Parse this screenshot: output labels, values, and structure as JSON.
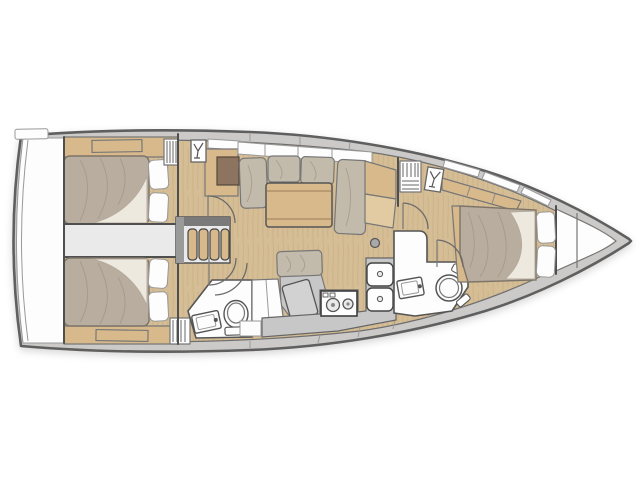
{
  "figure": {
    "type": "yacht-interior-floor-plan",
    "orientation": "bow-right",
    "rooms": [
      {
        "name": "stern-transom",
        "items": [
          "swim-platform",
          "boarding-step"
        ]
      },
      {
        "name": "aft-cabin-port",
        "items": [
          "double-berth",
          "pillow",
          "pillow",
          "storage-shelf",
          "louvered-locker",
          "cabin-door"
        ]
      },
      {
        "name": "aft-cabin-starboard",
        "items": [
          "double-berth",
          "pillow",
          "pillow",
          "storage-shelf",
          "louvered-locker",
          "cabin-door"
        ]
      },
      {
        "name": "companionway",
        "items": [
          "ladder-steps",
          "wardrobe-cabinet",
          "deck-hatch"
        ]
      },
      {
        "name": "aft-head",
        "items": [
          "toilet",
          "washbasin",
          "shower-bench",
          "door"
        ]
      },
      {
        "name": "salon",
        "items": [
          "u-shaped-settee",
          "folding-table",
          "sideboard",
          "nav-seat",
          "nav-desk",
          "mast-post"
        ]
      },
      {
        "name": "galley",
        "items": [
          "two-burner-stove",
          "double-sink",
          "worktop"
        ]
      },
      {
        "name": "forward-head",
        "items": [
          "toilet",
          "washbasin",
          "door"
        ]
      },
      {
        "name": "forward-cabin",
        "items": [
          "island-double-berth",
          "pillow",
          "pillow",
          "storage-shelf",
          "louvered-locker",
          "deck-hatch",
          "cabin-door"
        ]
      },
      {
        "name": "bow",
        "items": [
          "anchor-locker-bulkhead",
          "anchor-locker-bulkhead"
        ]
      }
    ]
  },
  "colors": {
    "page_bg": "#ffffff",
    "hull_outline": "#5f5f5f",
    "deck": "#cbcac8",
    "wall": "#4f4f4f",
    "floor": "#d5bd95",
    "floor_grain": "#c3a87c",
    "wood": "#d7b98b",
    "wood_light": "#e2cba2",
    "wood_dark": "#8d7460",
    "mattress": "#b8ad9f",
    "crease": "#a2968a",
    "cushion": "#c2bbac",
    "sheet": "#eee9df",
    "white": "#fdfdfd",
    "light_gray": "#eaeaea",
    "mid_gray": "#c7c7c7",
    "surface_gray": "#d2d2d2"
  }
}
